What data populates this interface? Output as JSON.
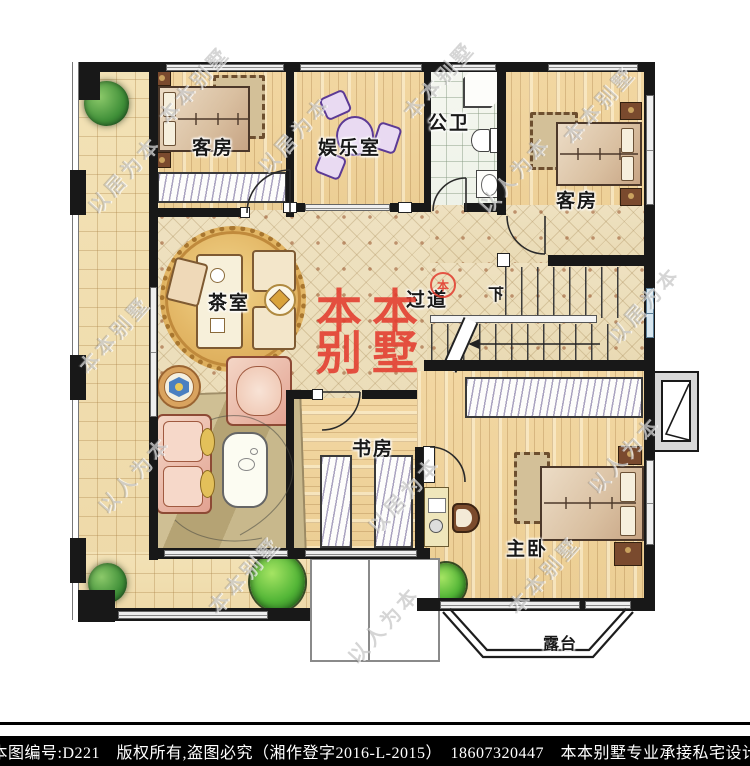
{
  "plan": {
    "rooms": {
      "guest1": "客房",
      "entertainment": "娱乐室",
      "bath": "公卫",
      "guest2": "客房",
      "tea": "茶室",
      "hall": "过道",
      "study": "书房",
      "master": "主卧",
      "terrace": "露台"
    },
    "stairs": {
      "down_label": "下"
    }
  },
  "branding": {
    "logo_line1": "本本",
    "logo_line2": "别墅",
    "seal_char": "本"
  },
  "watermarks": {
    "t1": "本本别墅",
    "t2": "以居为本",
    "t3": "以人为本"
  },
  "footer": {
    "line": "本图编号:D221　版权所有,盗图必究（湘作登字2016-L-2015）　18607320447　本本别墅专业承接私宅设计"
  },
  "colors": {
    "wall": "#181818",
    "accent_red": "#e23b2e",
    "floor_wood": "#f2d7a2",
    "floor_hall": "#eee1c0",
    "tree_green": "#3f8f38"
  }
}
